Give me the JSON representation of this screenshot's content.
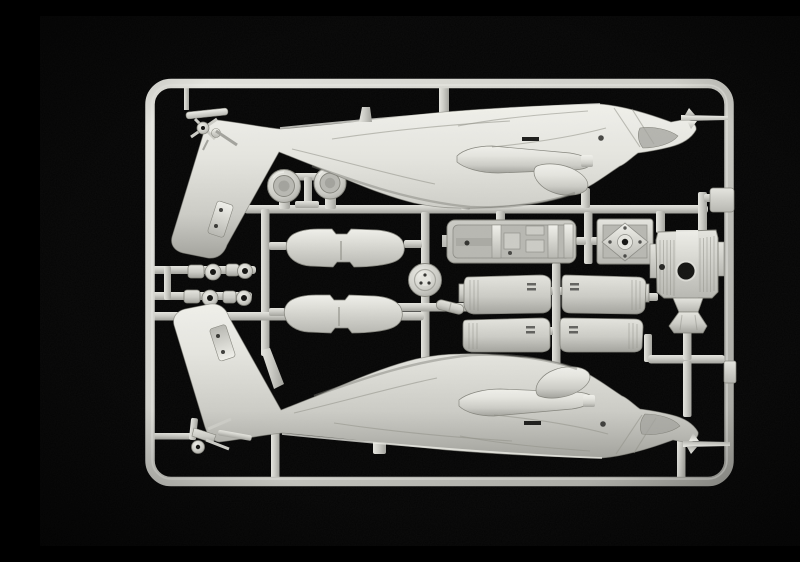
{
  "scene": {
    "image_type": "photograph",
    "subject": "Plastic scale-model helicopter kit sprue",
    "description": "Macro photo of an injection-moulded light grey polystyrene sprue on a black background. The rounded rectangular runner frame holds two mirrored helicopter fuselage halves (tail booms with vertical fins at left, gun-nosed fuselages pointing right), two round engine intake rings, four small wheel/rotor hubs, two flat stabilator panels, a round rotor-head disc, a cockpit tub, a square main-gearbox plate, four engine cowling halves and a ribbed engine deck fairing, all joined by internal runner bars.",
    "material": "light grey polystyrene",
    "background": "black studio backdrop",
    "aria_label": "Photograph of a grey plastic model kit sprue with helicopter fuselage halves and detail parts on a black background"
  },
  "colors": {
    "bg": "#050505",
    "plastic_lightest": "#f0f0ea",
    "plastic_light": "#e4e4de",
    "plastic_base": "#cbcbc5",
    "plastic_mid": "#b7b7b1",
    "plastic_shadow": "#a2a29c",
    "plastic_deep": "#8a8a84",
    "hole": "#141412",
    "detail_dark": "#1d1d1b",
    "panel_line": "#93938b"
  },
  "parts": [
    {
      "name": "sprue-frame",
      "label": "Rounded rectangular sprue frame (runner)"
    },
    {
      "name": "runner-network",
      "label": "Internal runner bars connecting all parts"
    },
    {
      "name": "fuselage-half-top",
      "label": "Upper fuselage half: tail boom and fin at left, nose gun at right"
    },
    {
      "name": "fuselage-half-bottom",
      "label": "Lower fuselage half, mirrored moulding of the upper half"
    },
    {
      "name": "tail-rotor-cluster",
      "label": "Tail rotor hub and stabilator small parts, top left"
    },
    {
      "name": "tail-wheel-cluster",
      "label": "Tail wheel strut assembly, bottom left"
    },
    {
      "name": "engine-intake-ring-left",
      "label": "Round engine intake ring part, left"
    },
    {
      "name": "engine-intake-ring-right",
      "label": "Round engine intake ring part, right"
    },
    {
      "name": "wheel-hub-set",
      "label": "Four small wheel / rotor hub parts",
      "count": 4
    },
    {
      "name": "stabilator-panel-upper",
      "label": "Flat stabilator panel part, upper"
    },
    {
      "name": "stabilator-panel-lower",
      "label": "Flat stabilator panel part, lower"
    },
    {
      "name": "rotor-head-disc",
      "label": "Round rotor head disc part"
    },
    {
      "name": "linkage-lug",
      "label": "Small linkage lug part"
    },
    {
      "name": "cockpit-tub",
      "label": "Cockpit tub with seat bulkhead and consoles"
    },
    {
      "name": "gearbox-plate",
      "label": "Square main gearbox plate with central hub"
    },
    {
      "name": "engine-cowling-set",
      "label": "Four engine cowling half parts",
      "count": 4
    },
    {
      "name": "engine-deck",
      "label": "Ribbed engine deck fairing with rotor shaft hole"
    },
    {
      "name": "sprue-tab-upper",
      "label": "Moulding tab on right rail, upper"
    },
    {
      "name": "sprue-tab-lower",
      "label": "Moulding tab on right rail, lower"
    }
  ]
}
